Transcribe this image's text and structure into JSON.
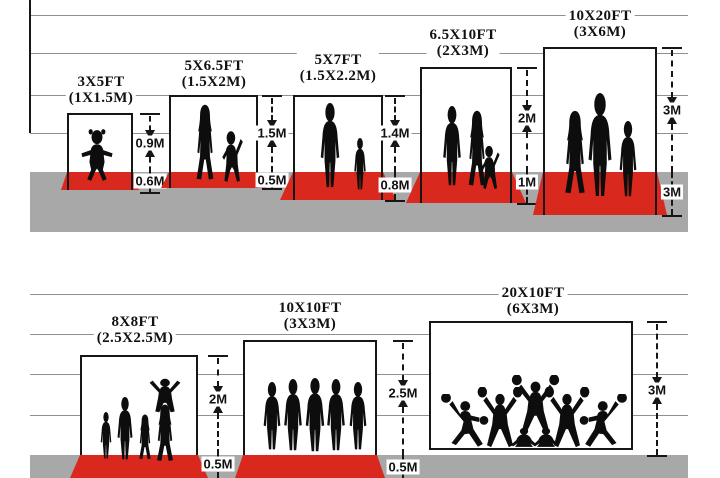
{
  "meta": {
    "title": "Backdrop / step-and-repeat banner size comparison diagram"
  },
  "colors": {
    "carpet": "#d9291e",
    "ground": "#a8a8a8",
    "grid": "#909090",
    "line": "#161616",
    "silhouette": "#0d0d0d",
    "background": "#ffffff"
  },
  "diagram": {
    "rows": [
      {
        "left": 30,
        "right": 688,
        "gridlines_y": [
          15,
          53,
          95,
          133
        ],
        "ground_top": 172,
        "ground_bottom": 232,
        "axis_x": 30,
        "axis_y1": 0,
        "axis_y2": 133
      },
      {
        "left": 30,
        "right": 688,
        "gridlines_y": [
          294,
          334,
          374,
          415
        ],
        "ground_top": 455,
        "ground_bottom": 478
      }
    ],
    "panels": [
      {
        "id": "3x5ft",
        "title": {
          "ft": "3X5FT",
          "m": "(1X1.5M)",
          "cx": 101,
          "top": 74
        },
        "size_ft": "3X5FT",
        "size_m": "1X1.5M",
        "wall_height": "0.9M",
        "floor_depth": "0.6M",
        "box": {
          "l": 67,
          "t": 113,
          "w": 66
        },
        "ground_y": 172,
        "carpet": {
          "bottom": 190,
          "spread": 6
        },
        "edge_through_carpet": true,
        "measure": {
          "x": 150,
          "top": 113,
          "l1": "0.9M",
          "l1y": 143,
          "l2": "0.6M",
          "l2y": 181,
          "bottom": 192,
          "bottom_tick": true
        },
        "figures": [
          {
            "type": "toddler",
            "cx": 97,
            "feet": 182,
            "h": 54,
            "w": 42
          }
        ]
      },
      {
        "id": "5x6.5ft",
        "title": {
          "ft": "5X6.5FT",
          "m": "(1.5X2M)",
          "cx": 214,
          "top": 58
        },
        "size_ft": "5X6.5FT",
        "size_m": "1.5X2M",
        "wall_height": "1.5M",
        "floor_depth": "0.5M",
        "box": {
          "l": 169,
          "t": 95,
          "w": 89
        },
        "ground_y": 172,
        "carpet": {
          "bottom": 188,
          "spread": 8
        },
        "edge_through_carpet": true,
        "measure": {
          "x": 272,
          "top": 95,
          "l1": "1.5M",
          "l1y": 133,
          "l2": "0.5M",
          "l2y": 180,
          "bottom": 188,
          "bottom_tick": true
        },
        "figures": [
          {
            "type": "woman",
            "cx": 205,
            "feet": 181,
            "h": 77,
            "w": 38
          },
          {
            "type": "kidwave",
            "cx": 232,
            "feet": 183,
            "h": 55,
            "w": 36,
            "flip": true
          }
        ]
      },
      {
        "id": "5x7ft",
        "title": {
          "ft": "5X7FT",
          "m": "(1.5X2.2M)",
          "cx": 338,
          "top": 52
        },
        "size_ft": "5X7FT",
        "size_m": "1.5X2.2M",
        "wall_height": "1.4M",
        "floor_depth": "0.8M",
        "box": {
          "l": 293,
          "t": 95,
          "w": 90
        },
        "ground_y": 172,
        "carpet": {
          "bottom": 200,
          "spread": 13
        },
        "edge_through_carpet": true,
        "measure": {
          "x": 395,
          "top": 95,
          "l1": "1.4M",
          "l1y": 133,
          "l2": "0.8M",
          "l2y": 185,
          "bottom": 200,
          "bottom_tick": true
        },
        "figures": [
          {
            "type": "man",
            "cx": 330,
            "feet": 188,
            "h": 85,
            "w": 42
          },
          {
            "type": "man",
            "cx": 360,
            "feet": 190,
            "h": 52,
            "w": 26
          }
        ]
      },
      {
        "id": "6.5x10ft",
        "title": {
          "ft": "6.5X10FT",
          "m": "(2X3M)",
          "cx": 463,
          "top": 27
        },
        "size_ft": "6.5X10FT",
        "size_m": "2X3M",
        "wall_height": "2M",
        "floor_depth": "1M",
        "box": {
          "l": 420,
          "t": 67,
          "w": 92
        },
        "ground_y": 172,
        "carpet": {
          "bottom": 203,
          "spread": 14
        },
        "edge_through_carpet": true,
        "measure": {
          "x": 527,
          "top": 67,
          "l1": "2M",
          "l1y": 118,
          "l2": "1M",
          "l2y": 182,
          "bottom": 203,
          "bottom_tick": true
        },
        "figures": [
          {
            "type": "man",
            "cx": 452,
            "feet": 186,
            "h": 80,
            "w": 40
          },
          {
            "type": "woman",
            "cx": 477,
            "feet": 187,
            "h": 77,
            "w": 38
          },
          {
            "type": "kidwave",
            "cx": 490,
            "feet": 190,
            "h": 47,
            "w": 32,
            "flip": true
          }
        ]
      },
      {
        "id": "10x20ft",
        "title": {
          "ft": "10X20FT",
          "m": "(3X6M)",
          "cx": 600,
          "top": 8
        },
        "size_ft": "10X20FT",
        "size_m": "3X6M",
        "wall_height": "3M",
        "floor_depth": "3M",
        "box": {
          "l": 543,
          "t": 47,
          "w": 114
        },
        "ground_y": 172,
        "carpet": {
          "bottom": 215,
          "spread": 10
        },
        "edge_through_carpet": true,
        "measure": {
          "x": 672,
          "top": 47,
          "l1": "3M",
          "l1y": 110,
          "l2": "3M",
          "l2y": 192,
          "bottom": 215,
          "bottom_tick": true
        },
        "figures": [
          {
            "type": "woman",
            "cx": 575,
            "feet": 195,
            "h": 85,
            "w": 44
          },
          {
            "type": "man",
            "cx": 600,
            "feet": 197,
            "h": 104,
            "w": 52
          },
          {
            "type": "man",
            "cx": 628,
            "feet": 197,
            "h": 76,
            "w": 38
          }
        ]
      },
      {
        "id": "8x8ft",
        "title": {
          "ft": "8X8FT",
          "m": "(2.5X2.5M)",
          "cx": 135,
          "top": 314
        },
        "size_ft": "8X8FT",
        "size_m": "2.5X2.5M",
        "wall_height": "2M",
        "floor_depth": "0.5M",
        "box": {
          "l": 80,
          "t": 355,
          "w": 118
        },
        "ground_y": 455,
        "carpet": {
          "bottom": 478,
          "spread": 10
        },
        "edge_through_carpet": false,
        "measure": {
          "x": 218,
          "top": 355,
          "l1": "2M",
          "l1y": 399,
          "l2": "0.5M",
          "l2y": 464,
          "bottom": 478,
          "bottom_tick": false
        },
        "figures": [
          {
            "type": "man",
            "cx": 106,
            "feet": 459,
            "h": 47,
            "w": 24
          },
          {
            "type": "man",
            "cx": 125,
            "feet": 460,
            "h": 63,
            "w": 34
          },
          {
            "type": "woman",
            "cx": 145,
            "feet": 460,
            "h": 46,
            "w": 26
          },
          {
            "type": "woman",
            "cx": 165,
            "feet": 462,
            "h": 58,
            "w": 36
          },
          {
            "type": "varms",
            "cx": 165,
            "feet": 413,
            "h": 36,
            "w": 44
          }
        ]
      },
      {
        "id": "10x10ft",
        "title": {
          "ft": "10X10FT",
          "m": "(3X3M)",
          "cx": 310,
          "top": 300
        },
        "size_ft": "10X10FT",
        "size_m": "3X3M",
        "wall_height": "2.5M",
        "floor_depth": "0.5M",
        "box": {
          "l": 243,
          "t": 340,
          "w": 134
        },
        "ground_y": 455,
        "carpet": {
          "bottom": 478,
          "spread": 8
        },
        "edge_through_carpet": false,
        "measure": {
          "x": 403,
          "top": 340,
          "l1": "2.5M",
          "l1y": 393,
          "l2": "0.5M",
          "l2y": 467,
          "bottom": 478,
          "bottom_tick": false
        },
        "figures": [
          {
            "type": "man",
            "cx": 272,
            "feet": 450,
            "h": 68,
            "w": 38
          },
          {
            "type": "man",
            "cx": 293,
            "feet": 451,
            "h": 72,
            "w": 40
          },
          {
            "type": "man",
            "cx": 315,
            "feet": 452,
            "h": 74,
            "w": 42
          },
          {
            "type": "man",
            "cx": 336,
            "feet": 451,
            "h": 72,
            "w": 40
          },
          {
            "type": "man",
            "cx": 358,
            "feet": 450,
            "h": 68,
            "w": 38
          }
        ]
      },
      {
        "id": "20x10ft",
        "title": {
          "ft": "20X10FT",
          "m": "(6X3M)",
          "cx": 533,
          "top": 285
        },
        "size_ft": "20X10FT",
        "size_m": "6X3M",
        "wall_height": "3M",
        "floor_depth": "",
        "box": {
          "l": 429,
          "t": 321,
          "w": 204,
          "closed": true,
          "bottom": 450
        },
        "ground_y": 455,
        "carpet": null,
        "edge_through_carpet": false,
        "measure": {
          "x": 657,
          "top": 321,
          "l1": "3M",
          "l1y": 390,
          "l2": null,
          "l2y": null,
          "bottom": 455,
          "bottom_tick": true
        },
        "figures": [
          {
            "type": "lunge",
            "cx": 462,
            "feet": 449,
            "h": 55,
            "w": 55,
            "flip": true
          },
          {
            "type": "cheer",
            "cx": 500,
            "feet": 449,
            "h": 62,
            "w": 52
          },
          {
            "type": "cheer",
            "cx": 535,
            "feet": 435,
            "h": 60,
            "w": 55
          },
          {
            "type": "cheer",
            "cx": 567,
            "feet": 449,
            "h": 62,
            "w": 52
          },
          {
            "type": "lunge",
            "cx": 605,
            "feet": 449,
            "h": 55,
            "w": 55
          },
          {
            "type": "sit",
            "cx": 524,
            "feet": 450,
            "h": 26,
            "w": 32
          },
          {
            "type": "sit",
            "cx": 546,
            "feet": 450,
            "h": 26,
            "w": 32
          }
        ]
      }
    ]
  }
}
